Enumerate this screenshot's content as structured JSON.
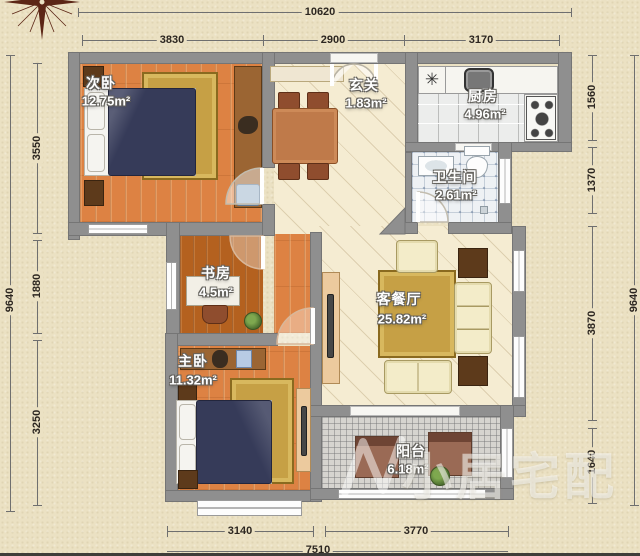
{
  "dimensions": {
    "top_total": "10620",
    "top_segments": [
      "3830",
      "2900",
      "3170"
    ],
    "left_total": "9640",
    "left_segments": [
      "3550",
      "1880",
      "3250"
    ],
    "right_total": "9640",
    "right_segments": [
      "1560",
      "1370",
      "3870",
      "1640"
    ],
    "bottom_segments": [
      "3140",
      "3770"
    ],
    "bottom_total": "7510"
  },
  "rooms": {
    "secondary_bedroom": {
      "name": "次卧",
      "area": "12.75m²"
    },
    "entry": {
      "name": "玄关",
      "area": "1.83m²"
    },
    "kitchen": {
      "name": "厨房",
      "area": "4.96m²"
    },
    "bathroom": {
      "name": "卫生间",
      "area": "2.61m²"
    },
    "study": {
      "name": "书房",
      "area": "4.5m²"
    },
    "living_dining": {
      "name": "客餐厅",
      "area": "25.82m²"
    },
    "master_bedroom": {
      "name": "主卧",
      "area": "11.32m²"
    },
    "balcony": {
      "name": "阳台",
      "area": "6.18m²"
    }
  },
  "symbols": {
    "kitchen_fixture": "✳"
  },
  "watermark": {
    "text": "小居宅配"
  }
}
